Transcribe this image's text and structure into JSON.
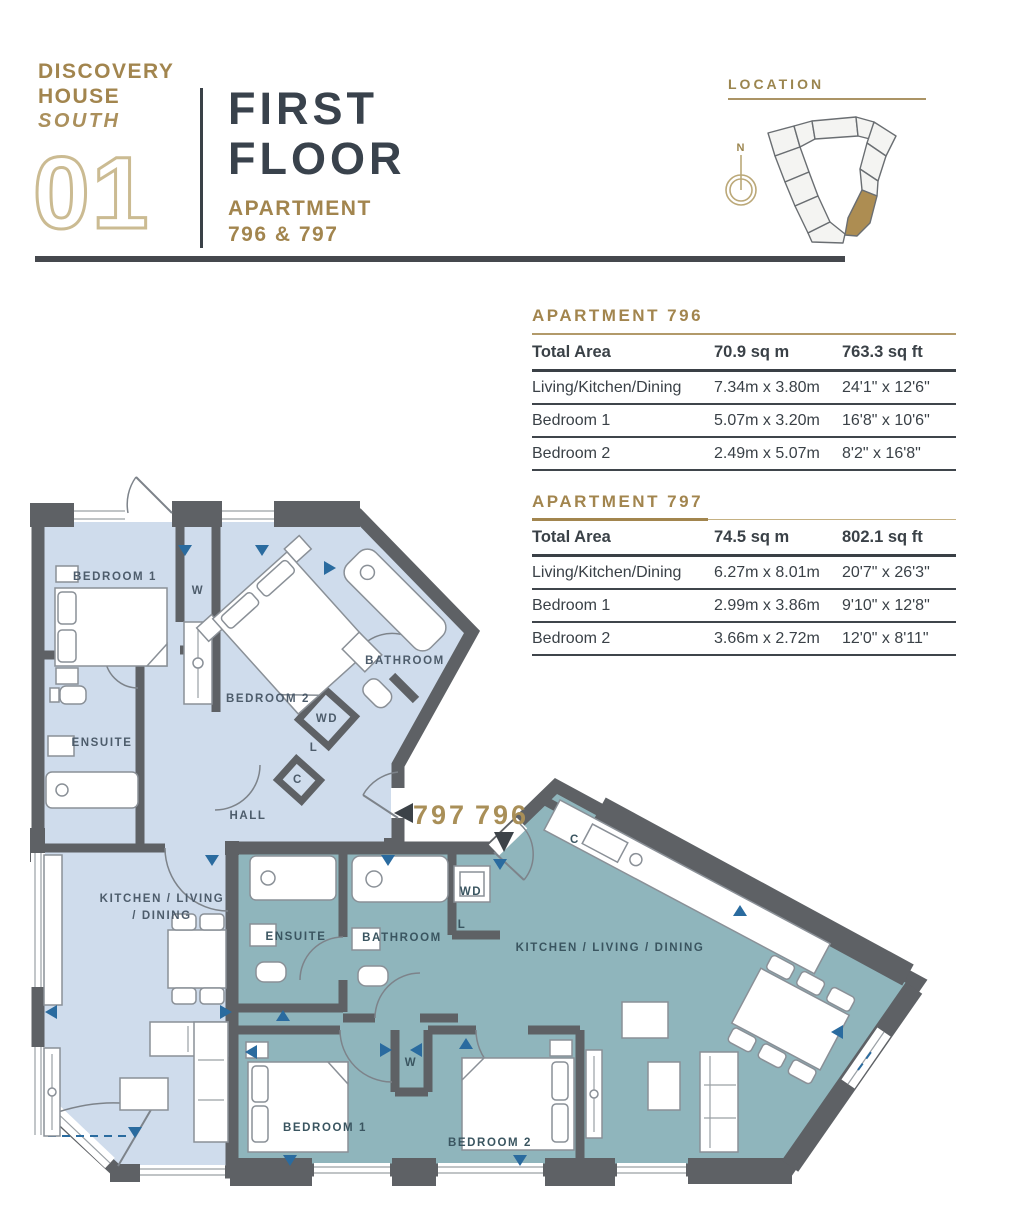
{
  "header": {
    "building_line1": "DISCOVERY",
    "building_line2": "HOUSE",
    "wing": "SOUTH",
    "floor_number": "01",
    "floor_line1": "FIRST",
    "floor_line2": "FLOOR",
    "subtitle_line1": "APARTMENT",
    "subtitle_line2": "796 & 797"
  },
  "location": {
    "label": "LOCATION",
    "compass_north": "N"
  },
  "tables": [
    {
      "title": "APARTMENT  796",
      "header": {
        "name": "Total Area",
        "metric": "70.9 sq m",
        "imperial": "763.3 sq ft"
      },
      "rows": [
        {
          "name": "Living/Kitchen/Dining",
          "metric": "7.34m x 3.80m",
          "imperial": "24'1\" x 12'6\""
        },
        {
          "name": "Bedroom 1",
          "metric": "5.07m x 3.20m",
          "imperial": "16'8\" x 10'6\""
        },
        {
          "name": "Bedroom 2",
          "metric": "2.49m x 5.07m",
          "imperial": "8'2\" x 16'8\""
        }
      ]
    },
    {
      "title": "APARTMENT  797",
      "header": {
        "name": "Total Area",
        "metric": "74.5 sq m",
        "imperial": "802.1 sq ft"
      },
      "rows": [
        {
          "name": "Living/Kitchen/Dining",
          "metric": "6.27m x 8.01m",
          "imperial": "20'7\" x 26'3\""
        },
        {
          "name": "Bedroom 1",
          "metric": "2.99m x 3.86m",
          "imperial": "9'10\" x 12'8\""
        },
        {
          "name": "Bedroom 2",
          "metric": "3.66m x 2.72m",
          "imperial": "12'0\" x 8'11\""
        }
      ]
    }
  ],
  "floorplan": {
    "apt797": {
      "number": "797",
      "bedroom1": "BEDROOM 1",
      "bedroom2": "BEDROOM 2",
      "bathroom": "BATHROOM",
      "ensuite": "ENSUITE",
      "hall": "HALL",
      "kitchen_line1": "KITCHEN / LIVING",
      "kitchen_line2": "/ DINING",
      "wardrobe": "W",
      "washer_dryer": "WD",
      "linen": "L",
      "cupboard": "C"
    },
    "apt796": {
      "number": "796",
      "bedroom1": "BEDROOM 1",
      "bedroom2": "BEDROOM 2",
      "bathroom": "BATHROOM",
      "ensuite": "ENSUITE",
      "kitchen": "KITCHEN / LIVING / DINING",
      "wardrobe": "W",
      "washer_dryer": "WD",
      "linen": "L",
      "cupboard": "C"
    }
  },
  "colors": {
    "gold": "#a2854e",
    "gold_outline": "#cbbb92",
    "dark": "#3a4147",
    "wall": "#5e6165",
    "apt797_fill": "#cfdcec",
    "apt796_fill": "#8fb5bc",
    "arrow_blue": "#2a6b9f",
    "location_highlight": "#ad8d52"
  }
}
